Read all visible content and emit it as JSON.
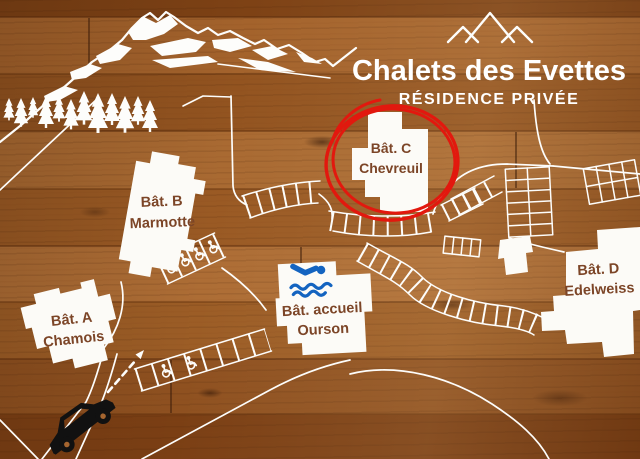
{
  "sign": {
    "title": "Chalets des Evettes",
    "subtitle": "RÉSIDENCE PRIVÉE"
  },
  "buildings": {
    "a": {
      "line1": "Bât. A",
      "line2": "Chamois"
    },
    "b": {
      "line1": "Bât. B",
      "line2": "Marmotte"
    },
    "c": {
      "line1": "Bât. C",
      "line2": "Chevreuil",
      "highlighted": true
    },
    "accueil": {
      "line1": "Bât. accueil",
      "line2": "Ourson",
      "amenity": "swimming-pool"
    },
    "d": {
      "line1": "Bât. D",
      "line2": "Edelweiss"
    }
  },
  "legend": {
    "highlight_color": "#e2180e",
    "line_color": "#ffffff",
    "pool_color": "#1464c0",
    "label_color": "#7c4527",
    "car_color": "#111111"
  },
  "icons": {
    "logo": "mountain-logo",
    "scenery": [
      "mountain-range",
      "pine-trees"
    ],
    "pool": "swimmer-icon",
    "accessible_parking": "wheelchair-icon",
    "vehicle": "car-icon",
    "route": "direction-arrow"
  }
}
